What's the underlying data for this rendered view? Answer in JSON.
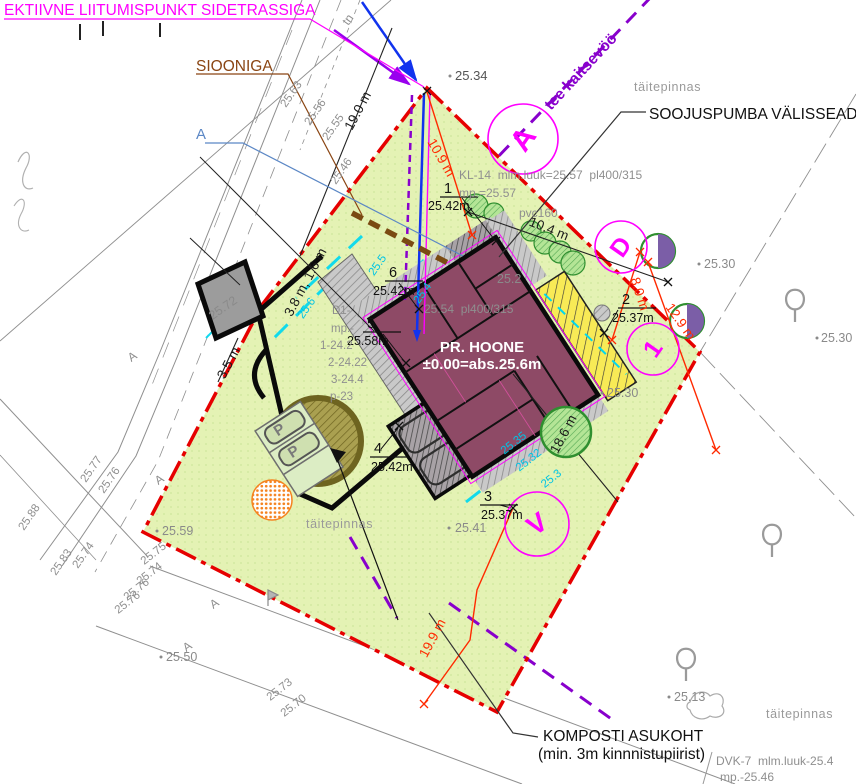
{
  "plan": {
    "labels": {
      "sidetrassiga": "EKTIIVNE LIITUMISPUNKT SIDETRASSIGA",
      "siooniga": "SIOONIGA",
      "ref_a_blue": "A",
      "soojuspumba": "SOOJUSPUMBA VÄLISSEAD",
      "komposti_line1": "KOMPOSTI ASUKOHT",
      "komposti_line2": "(min. 3m kinnnistupiirist)",
      "tee_kaitsevoo": "tee kaitsevöö",
      "tn": "tn"
    },
    "building": {
      "name": "PR. HOONE",
      "zero_level": "±0.00=abs.25.6m",
      "interior_spot": "25.2"
    },
    "points": [
      {
        "no": "1",
        "elev": "25.42m"
      },
      {
        "no": "2",
        "elev": "25.37m"
      },
      {
        "no": "3",
        "elev": "25.37m"
      },
      {
        "no": "4",
        "elev": "25.42m"
      },
      {
        "no": "5",
        "elev": "25.58m"
      },
      {
        "no": "6",
        "elev": "25.42m"
      }
    ],
    "dims_red": [
      "10.9 m",
      "8.0 m",
      "12.9 m",
      "19.9 m"
    ],
    "dims_black": [
      "19.0 m",
      "3.8 m, 1.6 m",
      "3.5 m",
      "10.4 m",
      "18.6 m"
    ],
    "contour_labels": [
      "25.5",
      "25.4",
      "25.6",
      "25.35",
      "25.32",
      "25.3"
    ],
    "circle_markers": [
      "A",
      "D",
      "1",
      "V"
    ],
    "utilities": [
      "KL-14  mlm.luuk=25.57  pl400/315",
      "mp.=25.57",
      "pvc160",
      "25.54  pl400/315",
      "D1-",
      "mp.-",
      "1-24.2",
      "2-24.22",
      "3-24.4",
      "p-23",
      "DVK-7  mlm.luuk-25.4",
      "mp.-25.46"
    ],
    "surface_label": "täitepinnas",
    "parking_label": "P",
    "road_letter": "A",
    "spot_elevations": [
      "25.34",
      "25.30",
      "25.30",
      "25.30",
      "25.41",
      "25.59",
      "25.50",
      "25.13",
      "25.72"
    ],
    "road_elevations": [
      "25.63",
      "25.56",
      "25.55",
      "25.46",
      "25.88",
      "25.83",
      "25.77",
      "25.76",
      "25.74",
      "25.75",
      "25.74",
      "25.76",
      "25.76",
      "25.73",
      "25.70"
    ],
    "colors": {
      "parcel_green": "#e4f2b4",
      "boundary_red": "#e60000",
      "building_fill": "#8e4a66",
      "protection_purple": "#8800cc",
      "utility_magenta": "#ff00ff",
      "contour_cyan": "#00d8f0",
      "dim_red": "#ff2a00",
      "gas_brown": "#7a4a12",
      "water_blue": "#1133ee"
    }
  }
}
